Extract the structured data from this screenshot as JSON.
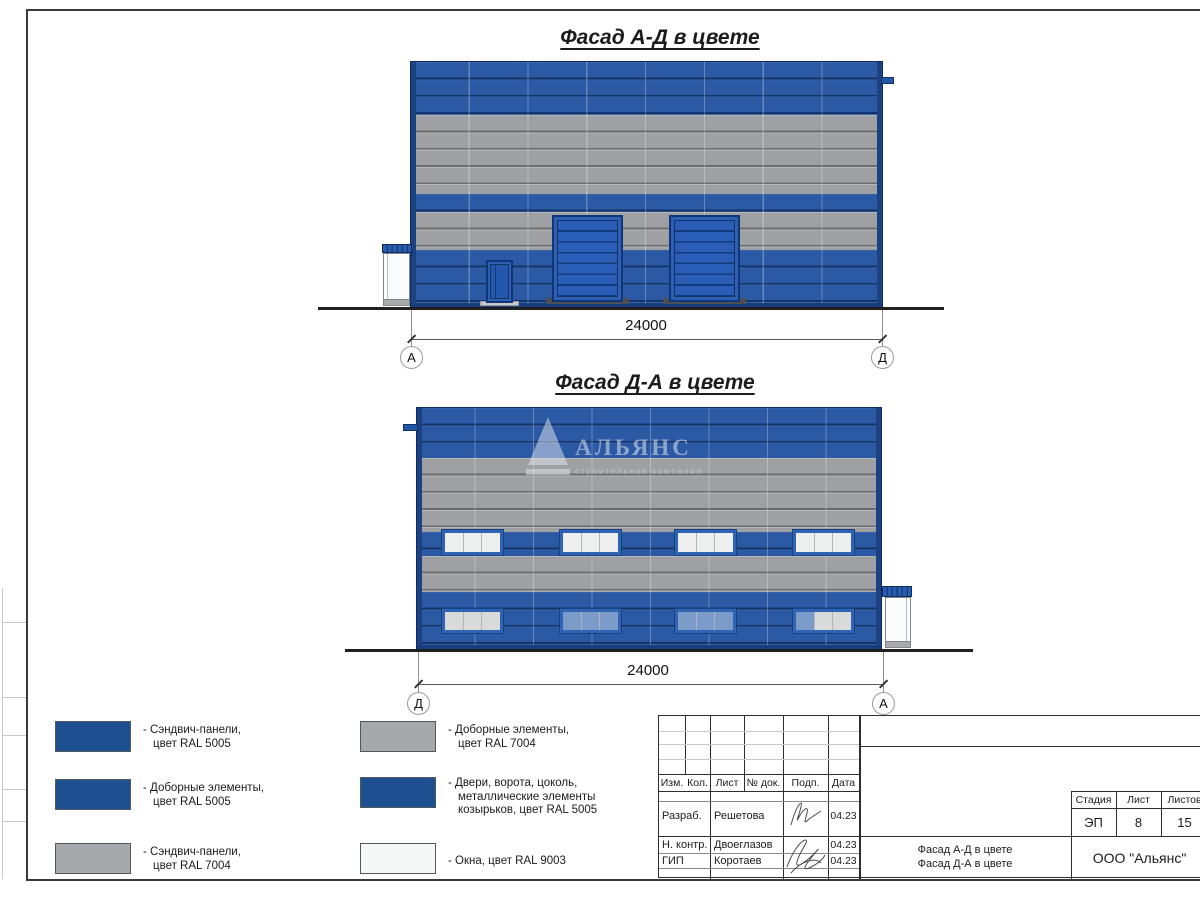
{
  "sheet": {
    "facade1_title": "Фасад А-Д в цвете",
    "facade2_title": "Фасад Д-А в цвете",
    "dim1": "24000",
    "dim2": "24000",
    "ax1_left": "А",
    "ax1_right": "Д",
    "ax2_left": "Д",
    "ax2_right": "А"
  },
  "watermark": {
    "brand": "АЛЬЯНС",
    "tagline": "строительная компания"
  },
  "legend": {
    "items": [
      {
        "color": "#1e4f91",
        "lines": [
          "- Сэндвич-панели,",
          "цвет RAL 5005"
        ]
      },
      {
        "color": "#1e4f91",
        "lines": [
          "- Доборные элементы,",
          "цвет RAL 5005"
        ]
      },
      {
        "color": "#a6a8ab",
        "lines": [
          "- Сэндвич-панели,",
          "цвет RAL 7004"
        ]
      },
      {
        "color": "#a6a8ab",
        "lines": [
          "- Доборные элементы,",
          "цвет RAL 7004"
        ]
      },
      {
        "color": "#1e4f91",
        "lines": [
          "- Двери, ворота, цоколь,",
          "металлические элементы",
          "козырьков, цвет RAL 5005"
        ]
      },
      {
        "color": "#f6f8f7",
        "lines": [
          "- Окна, цвет RAL 9003"
        ]
      }
    ]
  },
  "title_block": {
    "headers": [
      "Изм.",
      "Кол.",
      "Лист",
      "№ док.",
      "Подп.",
      "Дата"
    ],
    "rows": [
      {
        "role": "Разраб.",
        "name": "Решетова",
        "date": "04.23"
      },
      {
        "role": "Н. контр.",
        "name": "Двоеглазов",
        "date": "04.23"
      },
      {
        "role": "ГИП",
        "name": "Коротаев",
        "date": "04.23"
      }
    ],
    "stage_label": "Стадия",
    "sheet_label": "Лист",
    "sheets_label": "Листов",
    "stage": "ЭП",
    "sheet": "8",
    "sheets": "15",
    "doc_lines": [
      "Фасад А-Д в цвете",
      "Фасад Д-А в цвете"
    ],
    "company": "ООО \"Альянс\""
  },
  "colors": {
    "panel_blue": "#2b59a4",
    "panel_gray": "#9ea0a3",
    "corner_trim_navy": "#1d4281",
    "door_blue": "#2a5db5",
    "window_white": "#edefee",
    "window_tint": "#7b9cc9"
  }
}
